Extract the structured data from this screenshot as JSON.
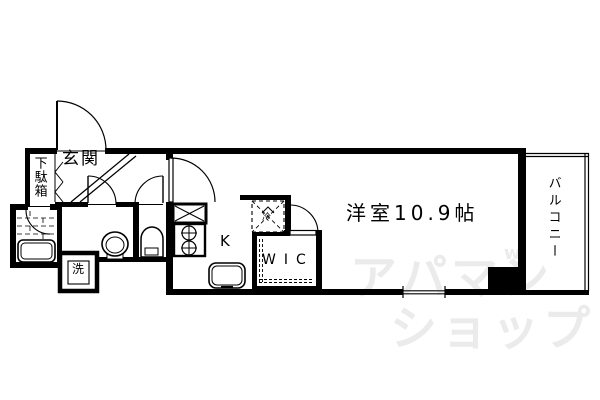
{
  "floorplan": {
    "labels": {
      "entrance": "玄関",
      "shoe_cabinet": "下駄箱",
      "washing_machine": "洗",
      "refrigerator": "冷",
      "kitchen": "K",
      "walk_in_closet": "WIC",
      "main_room": "洋室10.9帖",
      "balcony": "バルコニー"
    },
    "watermark": {
      "line1": "アパマン",
      "line2": "ショップ",
      "mark": "w"
    },
    "colors": {
      "wall": "#000000",
      "background": "#ffffff",
      "watermark": "#ebebeb"
    }
  }
}
